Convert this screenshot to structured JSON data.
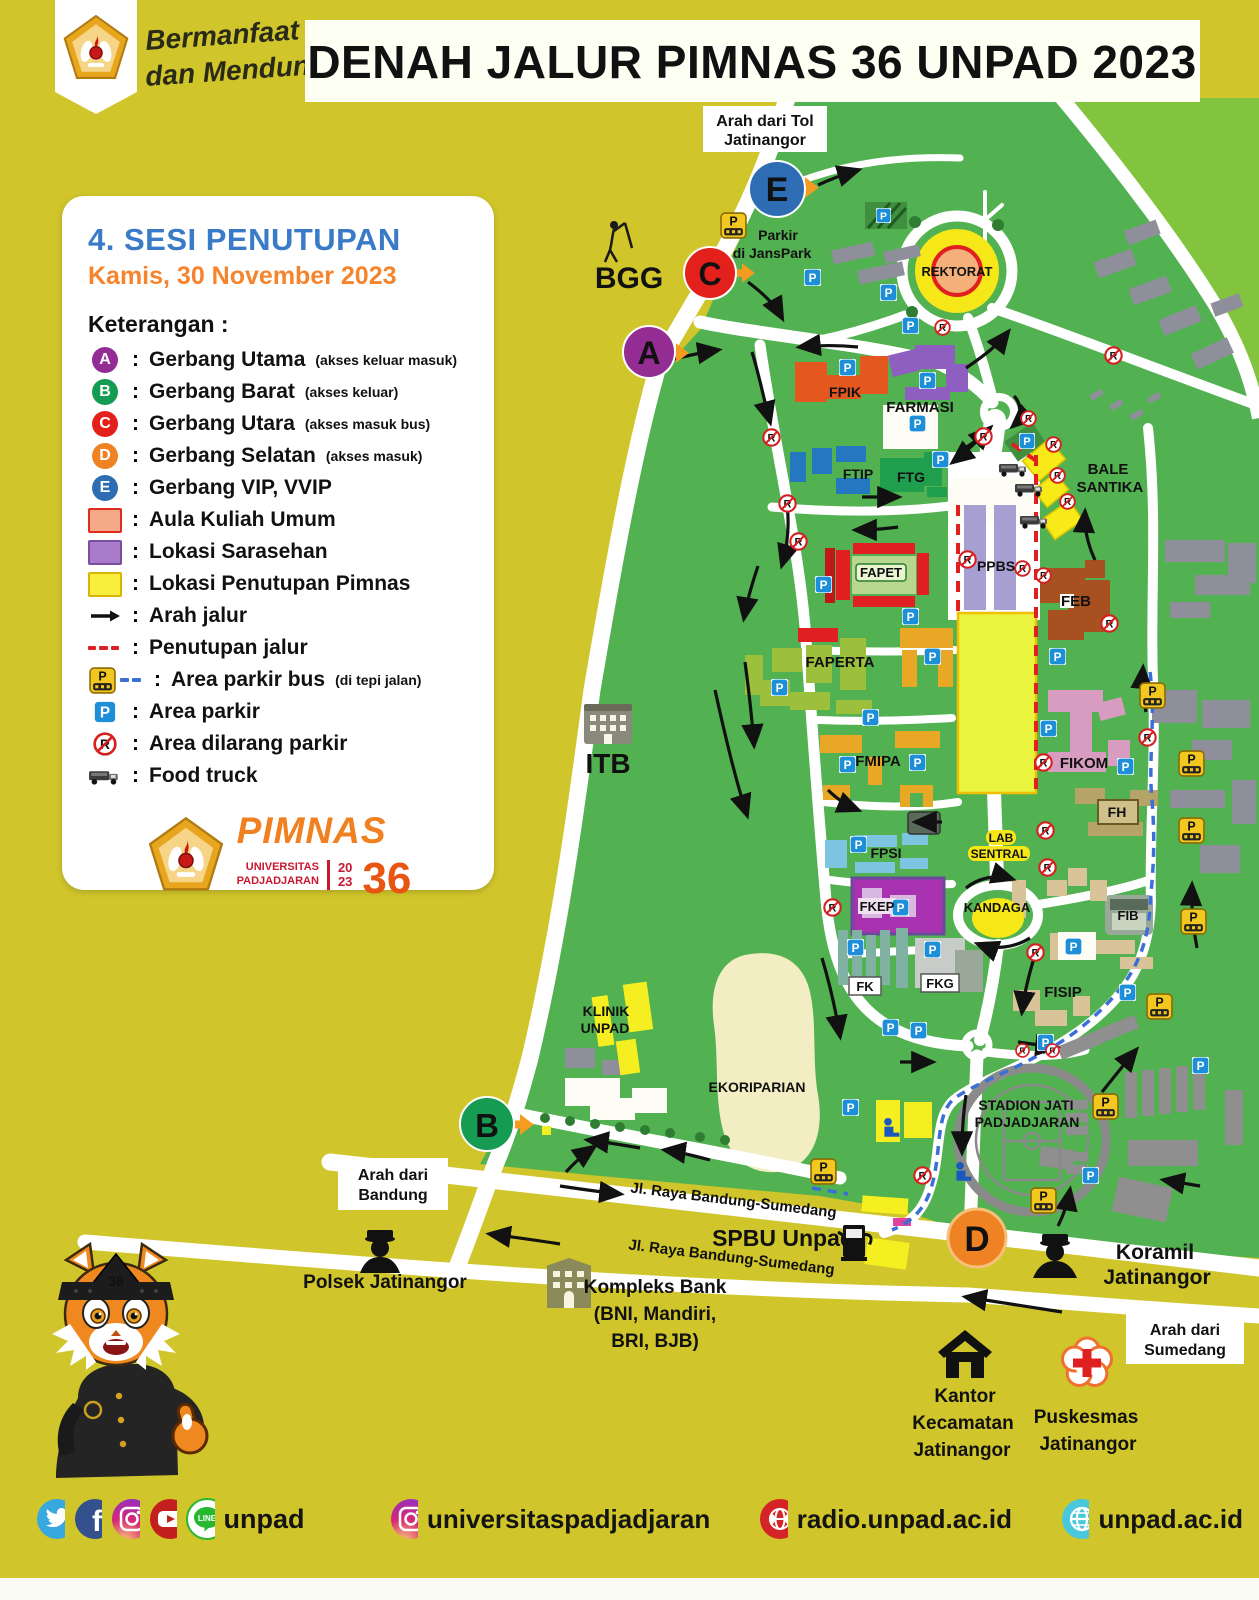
{
  "header": {
    "tagline_line1": "Bermanfaat",
    "tagline_line2": "dan Mendunia",
    "title": "DENAH JALUR PIMNAS 36 UNPAD 2023"
  },
  "legend": {
    "session_title": "4. SESI PENUTUPAN",
    "session_date": "Kamis, 30 November 2023",
    "heading": "Keterangan :",
    "colon": ":",
    "gates": [
      {
        "letter": "A",
        "color": "#942d93",
        "label": "Gerbang Utama",
        "note": "(akses keluar masuk)"
      },
      {
        "letter": "B",
        "color": "#169c52",
        "label": "Gerbang Barat",
        "note": "(akses keluar)"
      },
      {
        "letter": "C",
        "color": "#e3201b",
        "label": "Gerbang Utara",
        "note": "(akses masuk bus)"
      },
      {
        "letter": "D",
        "color": "#ef8222",
        "label": "Gerbang Selatan",
        "note": "(akses masuk)"
      },
      {
        "letter": "E",
        "color": "#2e6db4",
        "label": "Gerbang VIP, VVIP",
        "note": ""
      }
    ],
    "areas": [
      {
        "label": "Aula Kuliah Umum",
        "fill": "#f6a988",
        "border": "#e02b1d"
      },
      {
        "label": "Lokasi Sarasehan",
        "fill": "#a87cc8",
        "border": "#7a4ea0"
      },
      {
        "label": "Lokasi Penutupan Pimnas",
        "fill": "#faee3d",
        "border": "#d8b500"
      }
    ],
    "lines": [
      {
        "label": "Arah jalur",
        "note": ""
      },
      {
        "label": "Penutupan jalur",
        "note": ""
      },
      {
        "label": "Area parkir bus",
        "note": "(di tepi jalan)"
      },
      {
        "label": "Area parkir",
        "note": ""
      },
      {
        "label": "Area dilarang parkir",
        "note": ""
      },
      {
        "label": "Food truck",
        "note": ""
      }
    ]
  },
  "pimnas_logo": {
    "name": "PIMNAS",
    "university_line1": "UNIVERSITAS",
    "university_line2": "PADJADJARAN",
    "year_top": "20",
    "year_bottom": "23",
    "edition": "36"
  },
  "map": {
    "direction_labels": {
      "tol_line1": "Arah dari Tol",
      "tol_line2": "Jatinangor",
      "bandung_line1": "Arah dari",
      "bandung_line2": "Bandung",
      "sumedang_line1": "Arah dari",
      "sumedang_line2": "Sumedang"
    },
    "roads": {
      "jalan_raya_1": "Jl. Raya Bandung-Sumedang",
      "jalan_raya_2": "Jl. Raya Bandung-Sumedang"
    },
    "labels": {
      "bgg": "BGG",
      "itb": "ITB",
      "rektorat": "REKTORAT",
      "fpik": "FPIK",
      "farmasi": "FARMASI",
      "ftip": "FTIP",
      "ftg": "FTG",
      "bale_line1": "BALE",
      "bale_line2": "SANTIKA",
      "fapet": "FAPET",
      "ppbs": "PPBS",
      "feb": "FEB",
      "faperta": "FAPERTA",
      "fmipa": "FMIPA",
      "fikom": "FIKOM",
      "fh": "FH",
      "lab_line1": "LAB",
      "lab_line2": "SENTRAL",
      "fpsi": "FPSI",
      "kandaga": "KANDAGA",
      "fkep": "FKEP",
      "fib": "FIB",
      "fk": "FK",
      "fkg": "FKG",
      "fisip": "FISIP",
      "klinik_line1": "KLINIK",
      "klinik_line2": "UNPAD",
      "ekoriparian": "EKORIPARIAN",
      "stadion_line1": "STADION JATI",
      "stadion_line2": "PADJADJARAN",
      "janspark_line1": "Parkir",
      "janspark_line2": "di JansPark",
      "spbu": "SPBU Unpad"
    },
    "poi": {
      "polsek": "Polsek Jatinangor",
      "bank_line1": "Kompleks Bank",
      "bank_line2": "(BNI, Mandiri,",
      "bank_line3": "BRI, BJB)",
      "koramil_line1": "Koramil",
      "koramil_line2": "Jatinangor",
      "kecamatan_line1": "Kantor",
      "kecamatan_line2": "Kecamatan",
      "kecamatan_line3": "Jatinangor",
      "puskesmas_line1": "Puskesmas",
      "puskesmas_line2": "Jatinangor"
    },
    "icons": {
      "parking": "P",
      "parking_bus": "P",
      "no_parking": "R"
    }
  },
  "mascot": {
    "badge": "36"
  },
  "footer": {
    "handle_unpad": "unpad",
    "handle_instagram": "universitaspadjadjaran",
    "radio_url": "radio.unpad.ac.id",
    "web_url": "unpad.ac.id"
  },
  "colors": {
    "background": "#d0c52a",
    "campus_green": "#52b151",
    "light_green": "#83c43f",
    "closure_red": "#e02020",
    "bus_route_blue": "#3a6fd8",
    "highlight_yellow": "#e9f43e"
  }
}
